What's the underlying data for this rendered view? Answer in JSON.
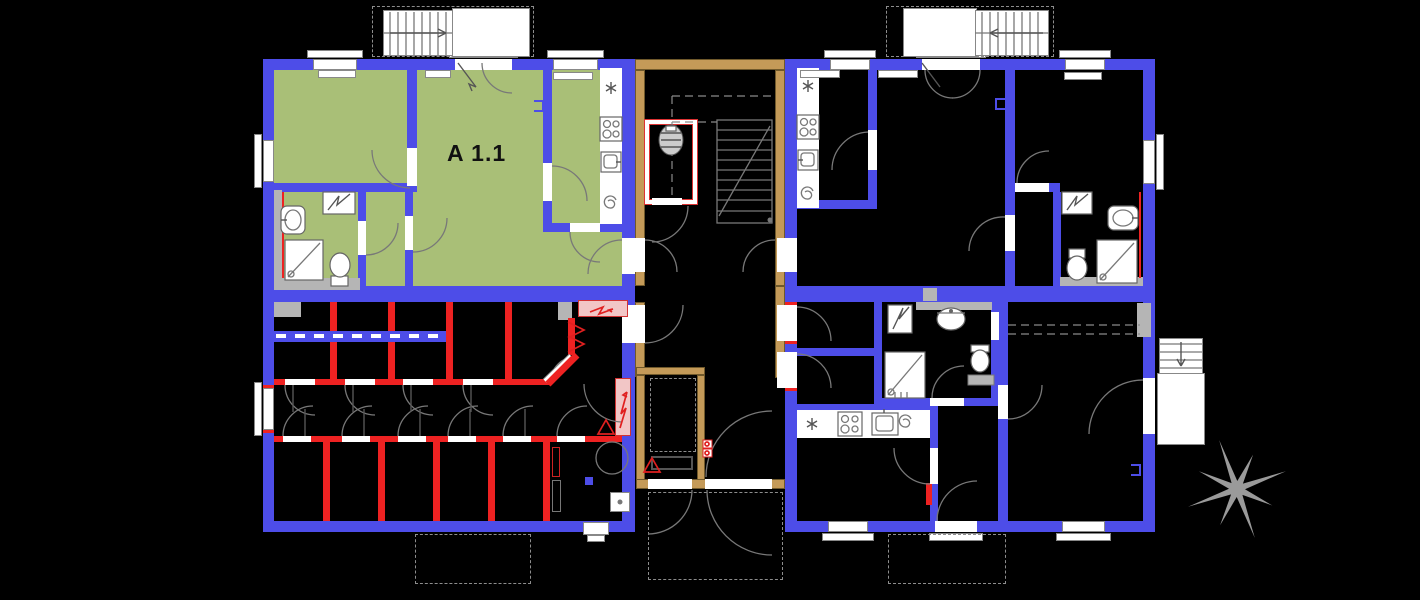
{
  "apartment": {
    "label": "A 1.1"
  },
  "colors": {
    "background": "#000000",
    "wall": "#4d4de8",
    "highlight_green": "#a9bf77",
    "new_wall_red": "#ee2222",
    "stair_core_tan": "#c49a58",
    "tan_edge": "#70592b",
    "panel_pink": "#f2c6c6",
    "panel_red": "#d23333",
    "line_gray": "#7d7d7d",
    "fill_gray": "#b5b5b5",
    "compass_gray": "#9a9a9a",
    "label_black": "#111111"
  },
  "icons": {
    "fridge": "asterisk",
    "stove": "four-burner-circles",
    "kitchen_sink": "square-basin-with-tap",
    "bath_sink": "oval-basin",
    "water_heater": "spiral",
    "boiler": "zigzag-box",
    "toilet": "bowl-with-tank",
    "shower": "square-with-diagonal",
    "elevator": "hatched-oval-in-red-shaft",
    "compass": "eight-point-star",
    "electric_panel": "pink-box-red-arrow",
    "warning": "red-triangle"
  }
}
